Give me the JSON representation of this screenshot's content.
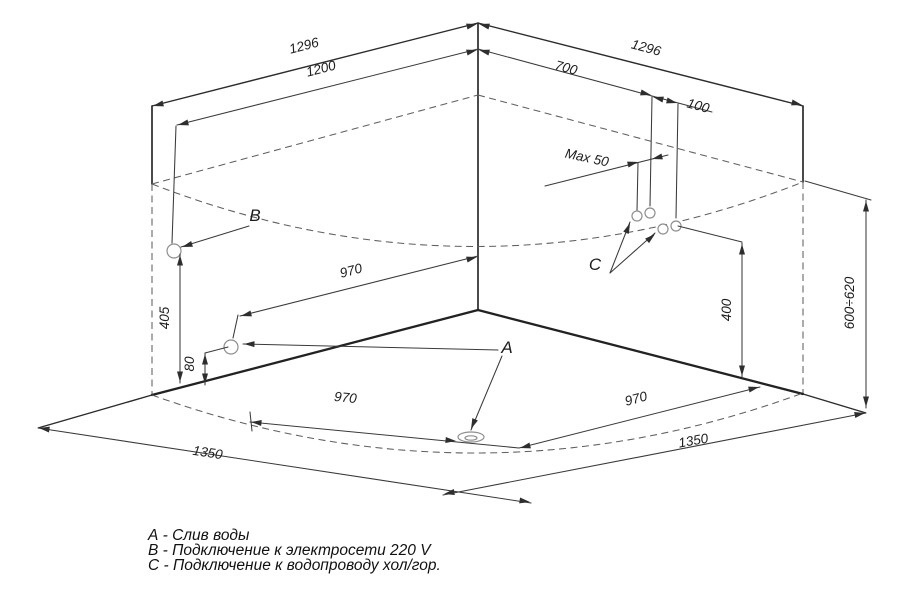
{
  "diagram": {
    "dimensions": {
      "left_wall_outer": "1296",
      "left_wall_opening": "1200",
      "right_wall_outer": "1296",
      "right_wall_to_water": "700",
      "water_pair_offset": "100",
      "water_max_spacing": "Max 50",
      "drain_wall_distance": "970",
      "floor_left_970": "970",
      "floor_right_970": "970",
      "floor_left_edge": "1350",
      "floor_right_edge": "1350",
      "electric_height": "405",
      "drain_height": "80",
      "water_height": "400",
      "rim_height": "600÷620"
    },
    "point_labels": {
      "drain": "A",
      "electric": "B",
      "water": "C"
    },
    "legend": {
      "items": [
        "А - Слив воды",
        "В - Подключение к электросети 220 V",
        "С - Подключение к водопроводу хол/гор."
      ]
    }
  }
}
